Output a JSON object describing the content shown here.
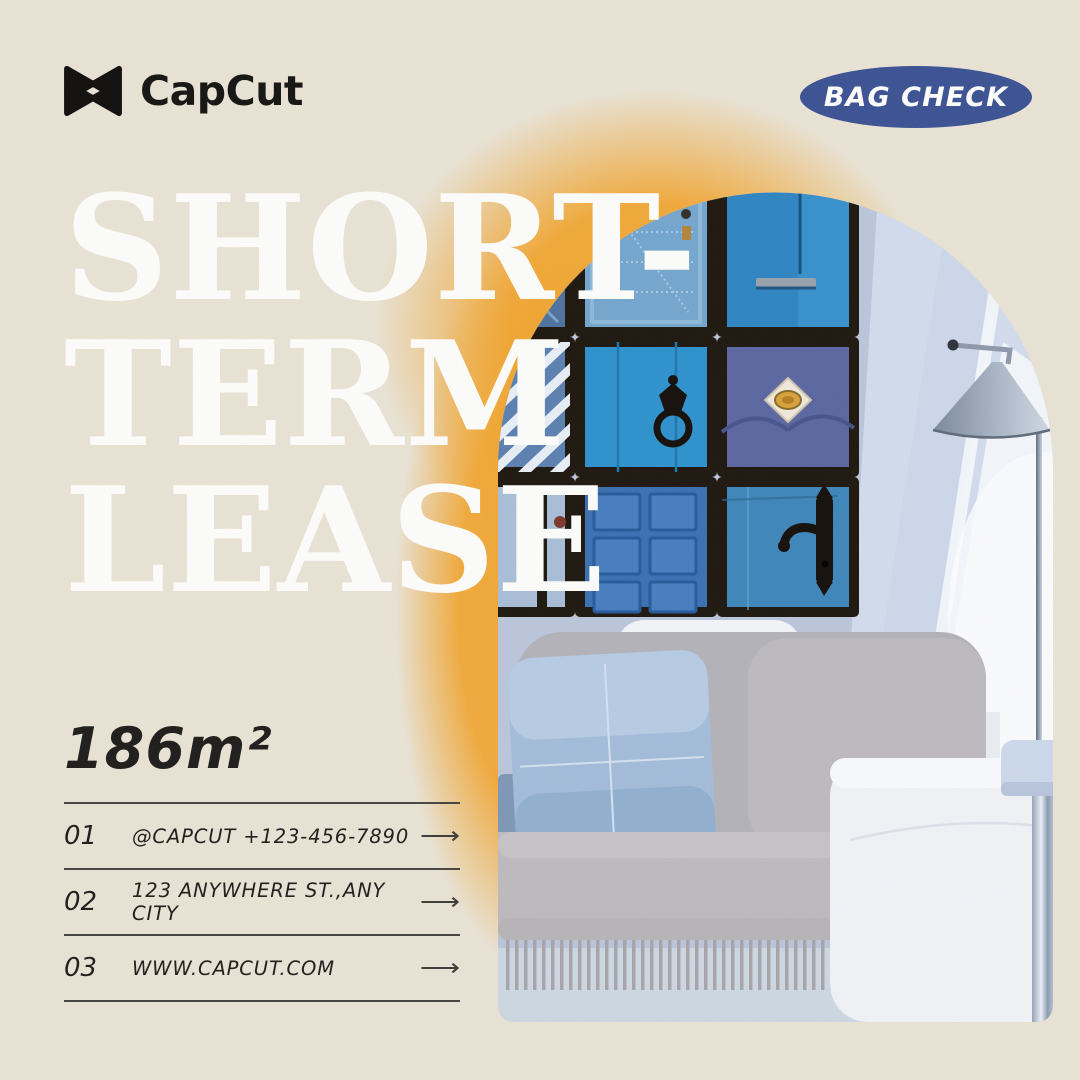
{
  "brand": {
    "name": "CapCut",
    "icon": "capcut-bowtie-icon"
  },
  "badge": {
    "label": "BAG CHECK",
    "bg_color": "#3b5294",
    "text_color": "#ffffff"
  },
  "headline": {
    "line1": "SHORT-",
    "line2": "TERM",
    "line3": "LEASE",
    "color": "#ffffff"
  },
  "area": {
    "value": "186m²"
  },
  "contact": {
    "arrow_icon": "arrow-right-icon",
    "rows": [
      {
        "num": "01",
        "label": "@CAPCUT  +123-456-7890",
        "arrow": "⟶"
      },
      {
        "num": "02",
        "label": "123 ANYWHERE ST.,ANY CITY",
        "arrow": "⟶"
      },
      {
        "num": "03",
        "label": "WWW.CAPCUT.COM",
        "arrow": "⟶"
      }
    ]
  },
  "colors": {
    "background": "#e9e3d5",
    "glow_orange": "#f1a42d",
    "badge_blue": "#3b5294",
    "ink": "#1e1d1b",
    "photo_wall_blue": "#bac6dc",
    "door_blue": "#2e92ce"
  }
}
